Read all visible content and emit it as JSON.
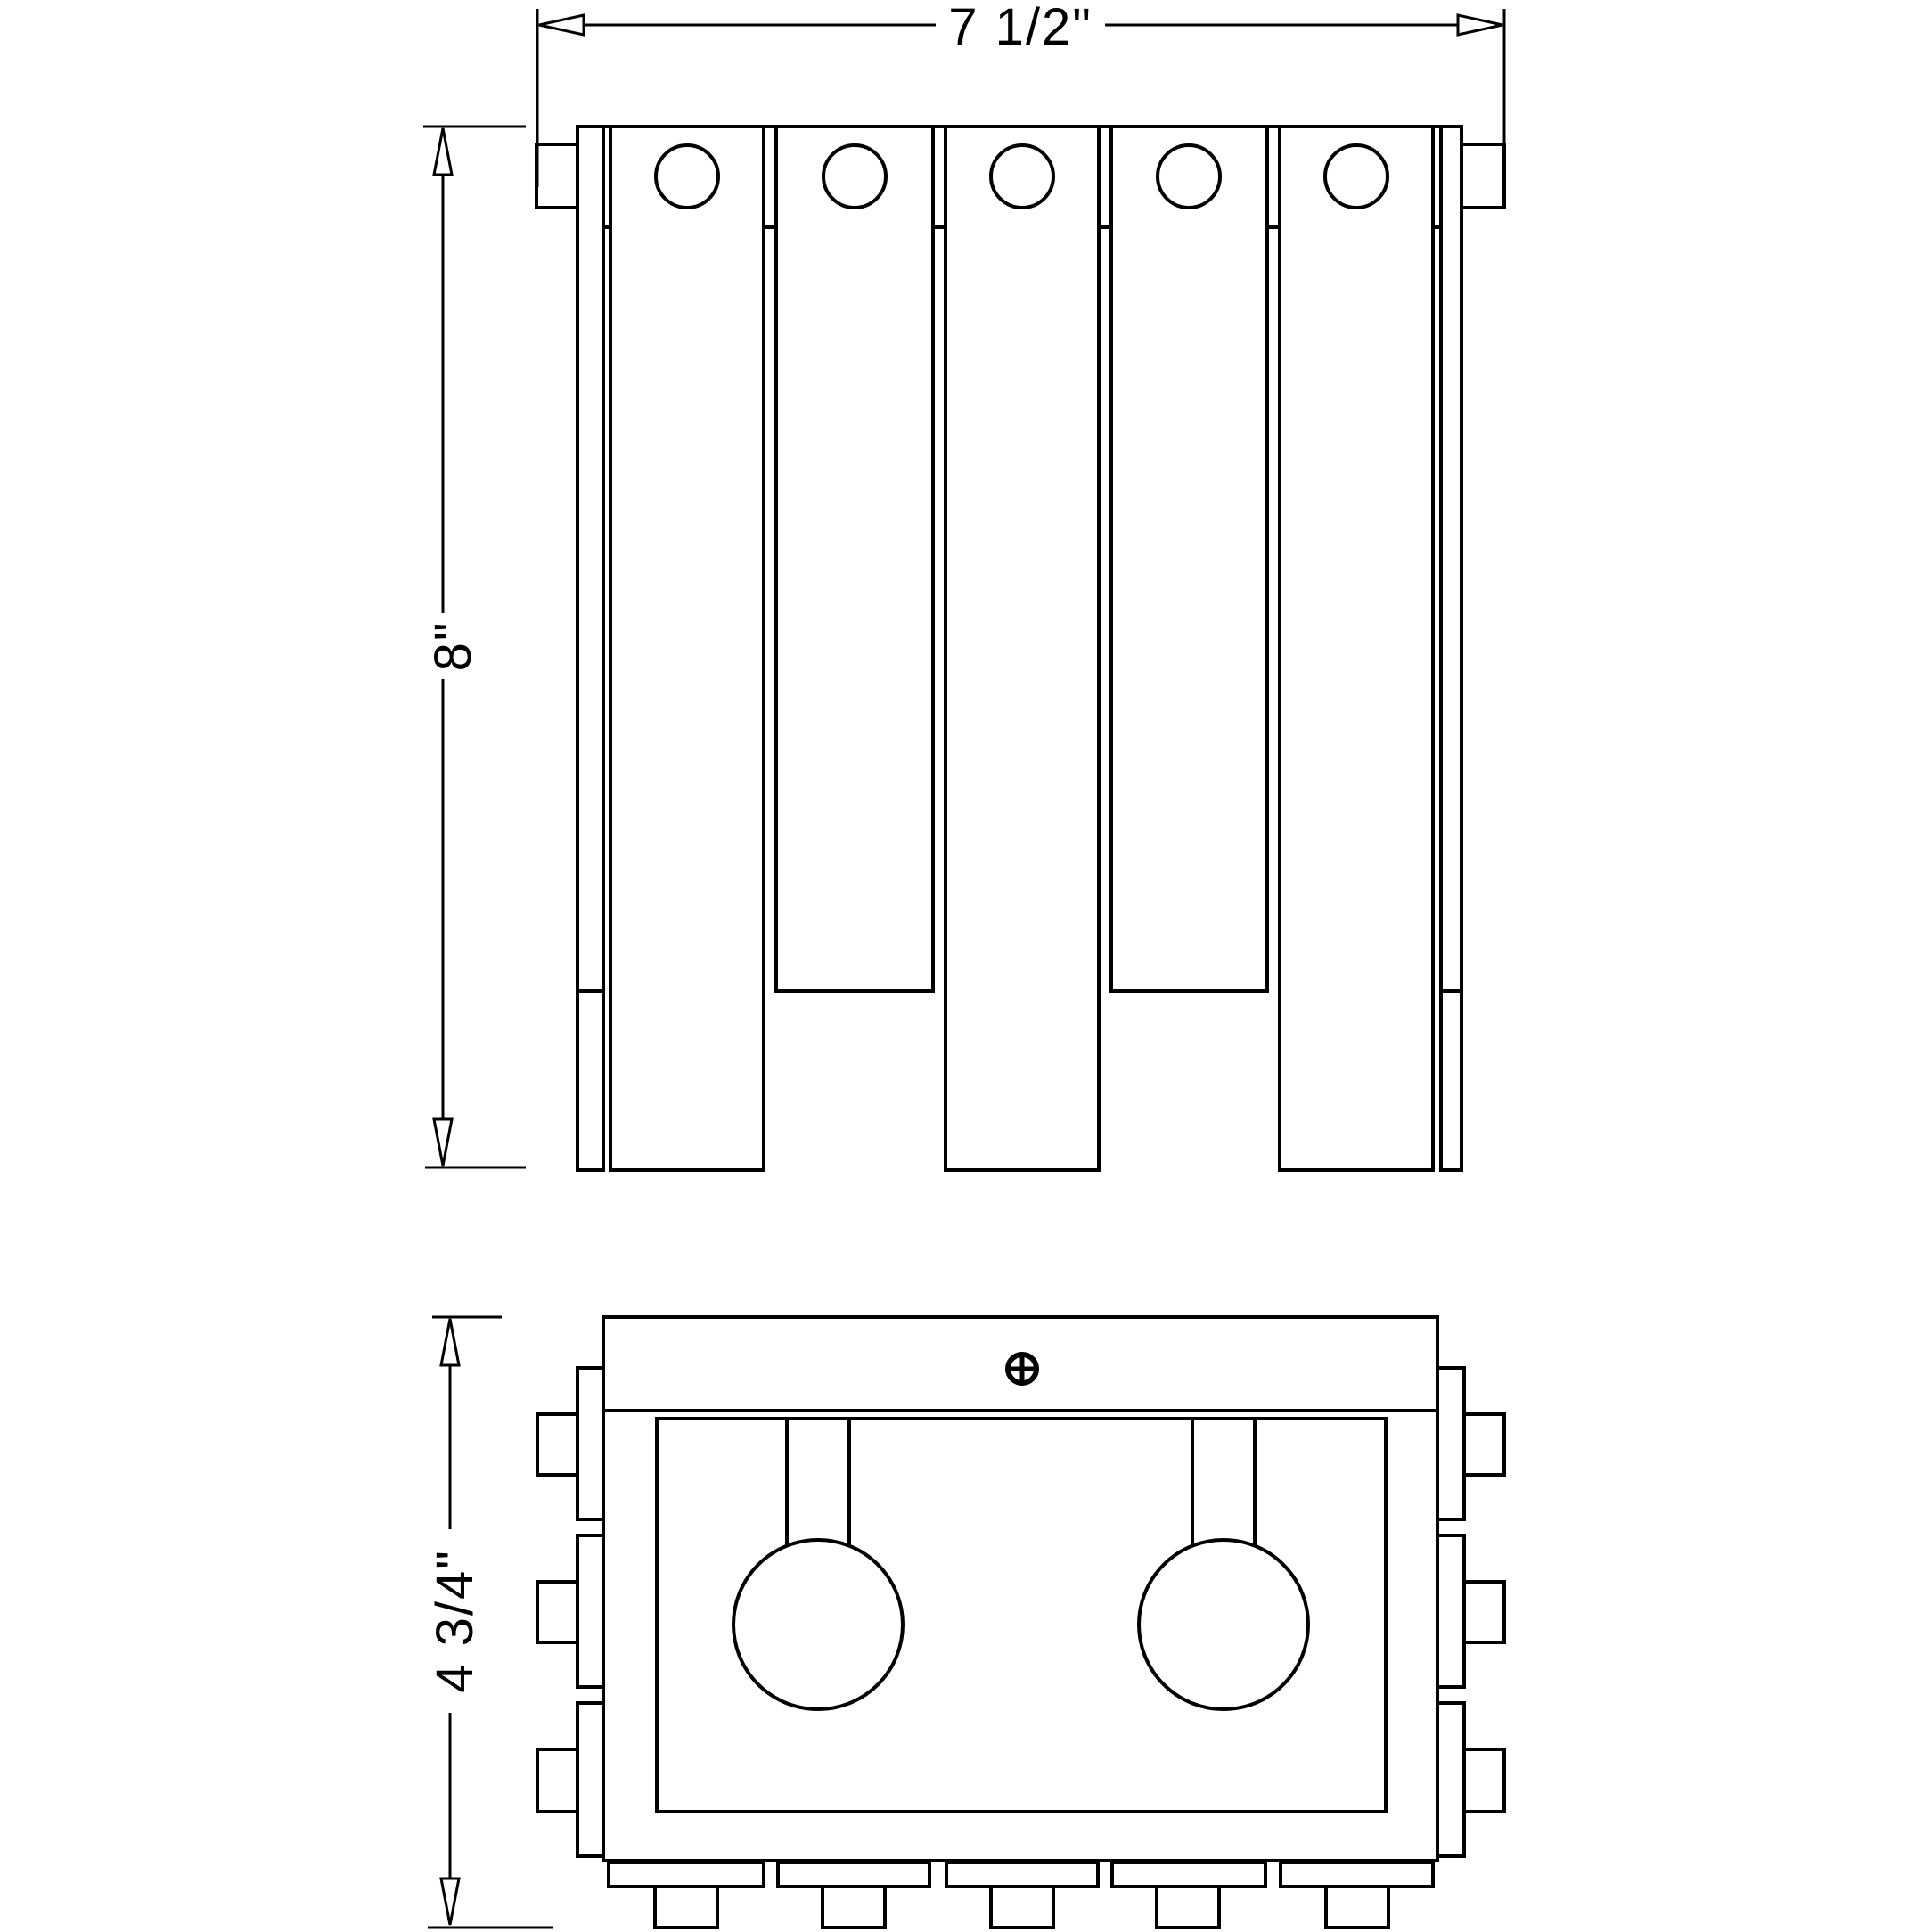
{
  "drawing": {
    "type": "technical-dimension-drawing",
    "background_color": "#ffffff",
    "line_color": "#000000",
    "dimensions": {
      "width": {
        "label": "7 1/2\""
      },
      "height": {
        "label": "8\""
      },
      "depth": {
        "label": "4 3/4\""
      }
    },
    "views": {
      "front_elevation": {
        "slat_count": 5,
        "hole_count": 5,
        "long_slats": [
          1,
          3,
          5
        ],
        "short_slats": [
          2,
          4
        ]
      },
      "top_plan": {
        "lamp_socket_count": 2,
        "mounting_screw_count": 1,
        "side_tab_pairs": 3,
        "bottom_feet_count": 5
      }
    },
    "icons": {
      "screw": "screw-head-icon"
    }
  }
}
